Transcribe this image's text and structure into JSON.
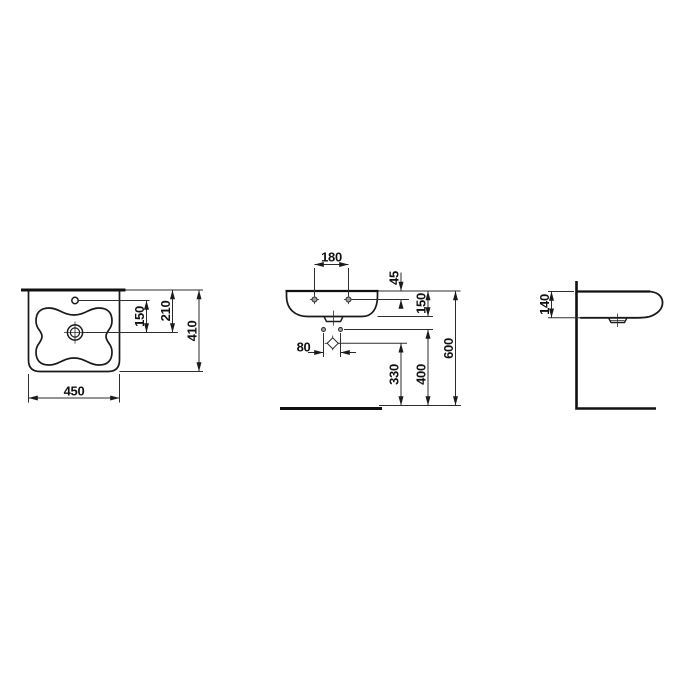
{
  "drawing": {
    "type": "washbasin technical dimension drawing",
    "line_color": "#1a1a1a",
    "background_color": "#ffffff",
    "views": {
      "top": {
        "name": "top view (plan)",
        "dims": {
          "overall_width": "450",
          "overall_depth": "410",
          "back_edge_to_drain": "210",
          "tap_hole_to_drain": "150"
        }
      },
      "front": {
        "name": "front view",
        "dims": {
          "mounting_hole_spacing": "180",
          "rim_to_mounting_holes": "45",
          "rim_to_outlet": "150",
          "fixing_hole_spacing": "80",
          "floor_to_trap": "330",
          "floor_to_fixing_holes": "400",
          "floor_to_rim": "600"
        }
      },
      "side": {
        "name": "side view",
        "dims": {
          "basin_height_at_wall": "140"
        }
      }
    }
  }
}
